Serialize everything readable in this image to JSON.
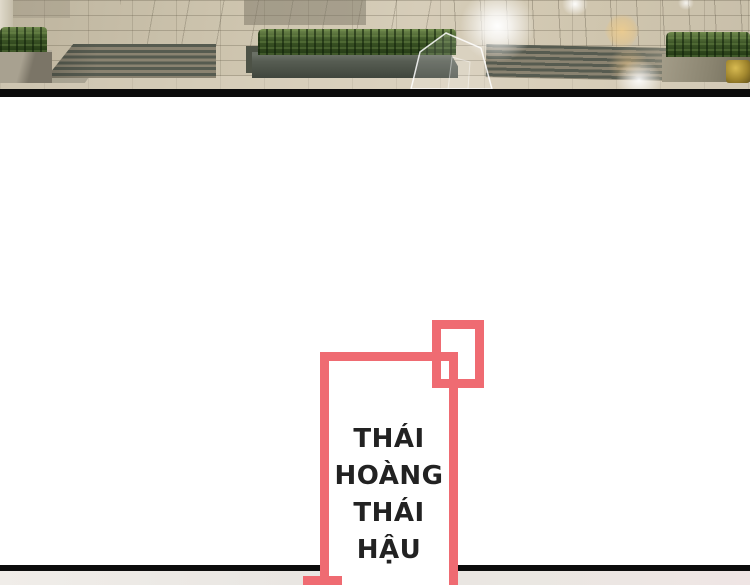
{
  "speech_bubble": {
    "lines": [
      "THÁI",
      "HOÀNG",
      "THÁI",
      "HẬU"
    ],
    "border_color": "#ef6b72",
    "background": "#ffffff",
    "text_color": "#222222"
  },
  "panel_dividers": {
    "top_color": "#0b0b0b",
    "bottom_color": "#0c0c0c"
  },
  "scene": {
    "ground_color": "#cdc4ae",
    "step_color": "#565b50",
    "hedge_color": "#3c5526",
    "planter_color": "#575d53",
    "gold_accent": "#c2a340",
    "flare_white": "#ffffff",
    "flare_warm": "#ecc17d"
  },
  "next_panel_strip": {
    "background": "#eae7e2"
  }
}
